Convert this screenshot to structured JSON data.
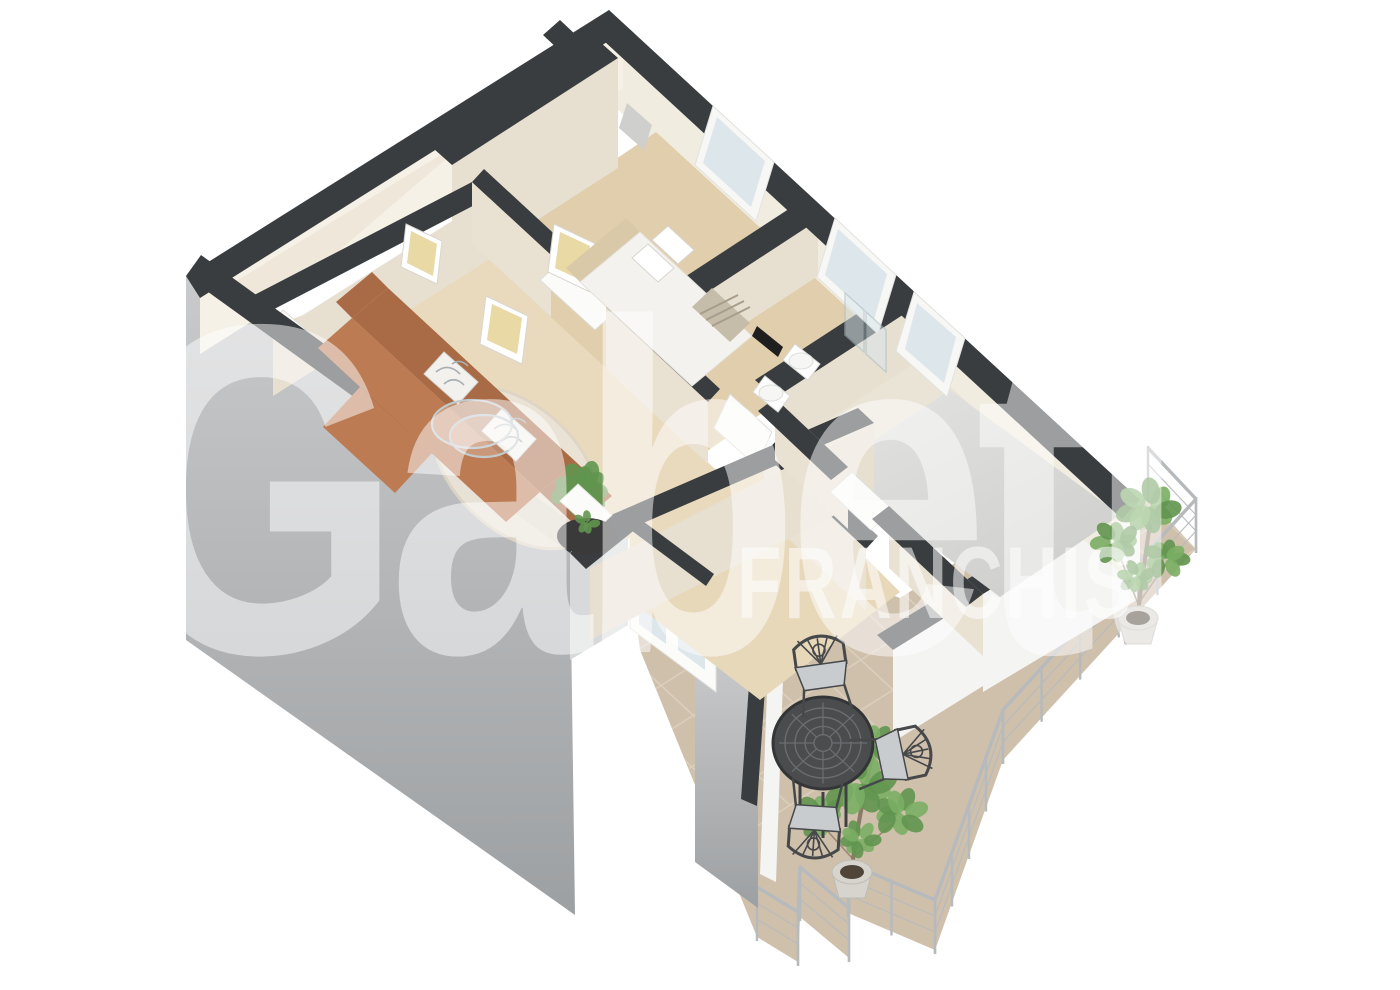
{
  "scene": {
    "type": "3d-isometric-floor-plan-render",
    "description": "Photorealistic 3D cutaway floor plan of an apartment viewed from above at an angle, with furnished living room, bedroom, bathroom, empty room, hallway with french doors and a large L-shaped tiled terrace with railing, bistro set and potted trees",
    "background": "#ffffff"
  },
  "watermark": {
    "brand_text": "Gabetti",
    "franchise_text": "FRANCHIS",
    "color": "#ffffff"
  },
  "rooms": {
    "living_room": "living room with terracotta corner sofa, patterned cushions, glass coffee table, round rug, fern plant, white side table and black console",
    "bedroom": "bedroom with double bed, pillows, foot runner, wall art and wardrobe niche",
    "bathroom": "bathroom with shower glass screen, bidet, toilet and black wall panel",
    "empty_room": "unfurnished room with gray floor",
    "hallway": "hall with white interior doors and glazed french doors to the terrace",
    "study": "small empty room at the top left",
    "terrace": "L-shaped tiled terrace with metal railing, round mesh bistro table, three chairs and two potted trees"
  },
  "colors": {
    "bg": "#ffffff",
    "wallTop": "#3a3d3f",
    "extGrayTop": "#c9cacc",
    "extGrayBottom": "#9da0a2",
    "nicheFace": "#d8d9da",
    "whiteFace": "#f4f4f3",
    "doorWhite": "#fbfbfa",
    "glass": "#dde6ea",
    "showerGlass": "#d9e5e9",
    "neInnerFace": "#f1ece0",
    "nwInnerFace": "#f6f1e6",
    "faceCreamSE": "#e7e0d1",
    "faceCreamSW": "#e9e2d3",
    "floorStudy": "#efe8da",
    "floorBedroom": "#e0ceac",
    "floorBath": "#eae4d7",
    "floorEmptyLight": "#e3e3e1",
    "floorEmptyDark": "#cfcfcd",
    "floorHall": "#e7d8ba",
    "floorLiving": "#e9dabd",
    "rug": "#ebe4d7",
    "sofa": "#bc7b53",
    "sofaDark": "#a96b46",
    "cushion": "#f2f1ee",
    "cushionLine": "#a8aeb2",
    "bedWhite": "#f4f2ee",
    "headboard": "#d9c9a8",
    "runner": "#c6bcaa",
    "tile": "#cfc0ac",
    "tileLine": "#dcd1bf",
    "railing": "#b6babd",
    "iron": "#46484a",
    "seatPad": "#c9ccce",
    "green": "#7aae64",
    "greenDark": "#61954f",
    "trunk": "#8a7a66",
    "pot": "#d6d4cd",
    "potDark": "#bdbbb3",
    "art": "#e9d9a4",
    "black": "#1f1f1f"
  }
}
